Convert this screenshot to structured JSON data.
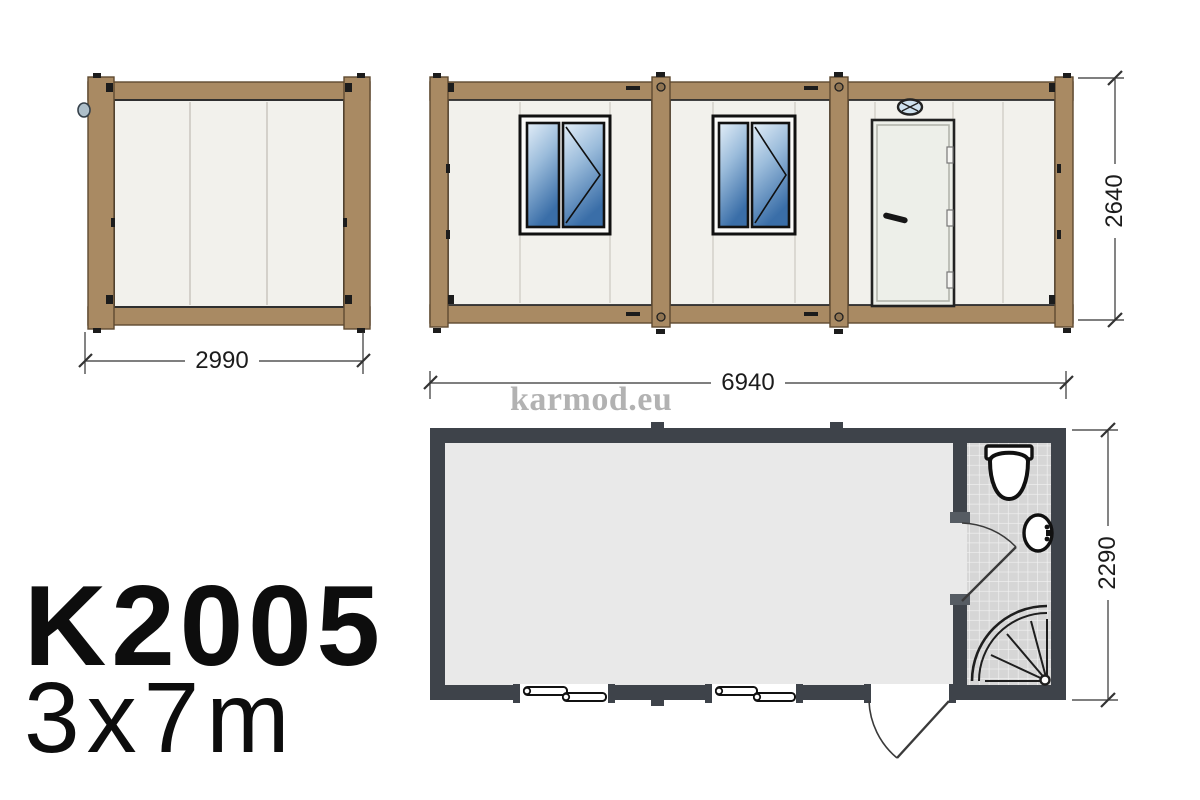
{
  "product": {
    "model_code": "K2005",
    "size_label": "3x7m"
  },
  "watermark_text": "karmod.eu",
  "dimensions_mm": {
    "end_width": "2990",
    "height": "2640",
    "length": "6940",
    "plan_width": "2290"
  },
  "views": {
    "end_elevation": {
      "wall_panels": 3
    },
    "front_elevation": {
      "modules": 3,
      "windows": 2,
      "entrance_doors": 1
    },
    "floor_plan": {
      "rooms": [
        "main-room",
        "bathroom"
      ],
      "bathroom_fixtures": [
        "toilet",
        "washbasin",
        "corner-shower"
      ],
      "openings": {
        "plan_windows": 2,
        "entrance_door": 1,
        "bathroom_door": 1
      }
    }
  },
  "icons": {
    "toilet": "toilet-icon",
    "washbasin": "sink-icon",
    "corner_shower": "shower-icon",
    "door_lamp": "lamp-icon"
  },
  "colors": {
    "frame_brown": "#a98a63",
    "frame_brown_dark": "#5f4a31",
    "panel_cream": "#f2f1ec",
    "window_glass_blue": "#3a6ea8",
    "plan_wall_dark": "#3e434a",
    "floor_gray": "#e9e9e9",
    "tile_gray": "#d6d6d6",
    "watermark_gray": "#b2b2b2",
    "text_black": "#0d0d0d"
  }
}
